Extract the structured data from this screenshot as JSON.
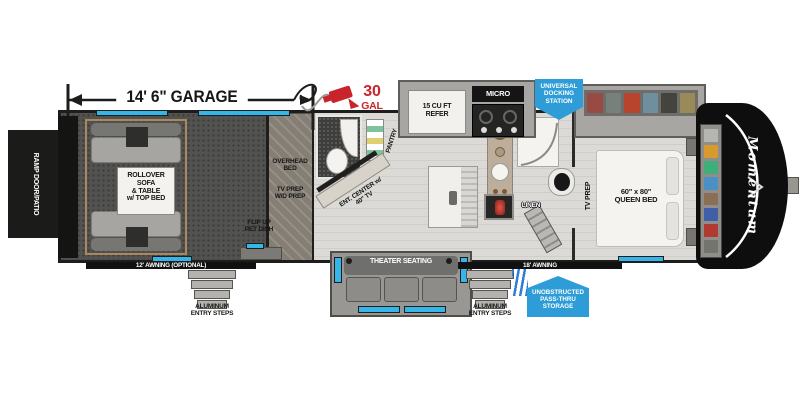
{
  "dimension": {
    "garage": "14' 6\" GARAGE"
  },
  "fuel": {
    "amount": "30",
    "unit": "GAL"
  },
  "garage": {
    "ramp_door": "RAMP DOOR/PATIO",
    "sofa": "ROLLOVER\nSOFA\n& TABLE\nw/ TOP BED",
    "pet_dish": "FLIP UP\nPET DISH",
    "awning": "12' AWNING (OPTIONAL)",
    "entry_steps": "ALUMINUM\nENTRY STEPS"
  },
  "mid_coach": {
    "overhead_bed": "OVERHEAD\nBED",
    "tv_wd_prep": "TV PREP\nW/D PREP",
    "pantry": "PANTRY",
    "ent_center": "ENT. CENTER w/\n40\" TV",
    "refer": "15 CU FT\nREFER",
    "micro": "MICRO",
    "linen": "LINEN",
    "theater_seating": "THEATER SEATING",
    "awning": "18' AWNING",
    "entry_steps": "ALUMINUM\nENTRY STEPS"
  },
  "bedroom": {
    "tv_prep": "TV PREP",
    "queen_bed": "60\" x 80\"\nQUEEN BED"
  },
  "badges": {
    "docking_station": "UNIVERSAL\nDOCKING\nSTATION",
    "pass_thru": "UNOBSTRUCTED\nPASS-THRU\nSTORAGE"
  },
  "brand": {
    "name": "Momentum"
  },
  "colors": {
    "window_cyan": "#35b5e8",
    "badge_blue": "#2e9cd6",
    "fuel_red": "#c8242b",
    "wall_black": "#1d1d1b",
    "wardrobe_items": [
      "#b5b5b1",
      "#d69a2e",
      "#3fae7a",
      "#4a90c4",
      "#8a6f55",
      "#3f5fa8",
      "#b03a30",
      "#74746f"
    ],
    "dresser_items": [
      "#9a4a44",
      "#77807a",
      "#b8442e",
      "#6f8f9e",
      "#44443f",
      "#9a8a5a"
    ]
  }
}
